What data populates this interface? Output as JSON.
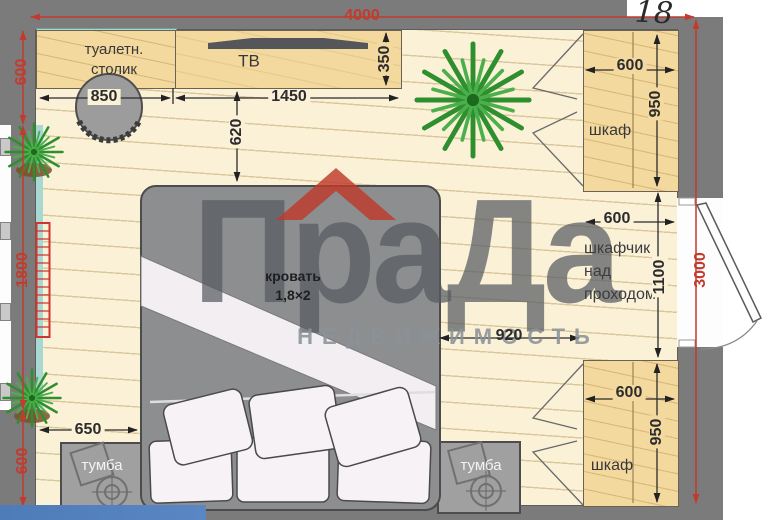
{
  "plan_type": "bedroom floor plan",
  "annotations": {
    "area_number": "18"
  },
  "watermark": {
    "brand": "ПраДа",
    "subtitle": "НЕДВИЖИМОСТЬ",
    "roof_color": "#c0392b"
  },
  "labels": {
    "vanity": "туалетн.\nстолик",
    "tv": "ТВ",
    "wardrobe_top": "шкаф",
    "wardrobe_bottom": "шкаф",
    "overhead_cabinet": "шкафчик\nнад\nпроходом",
    "bed": "кровать\n1,8×2",
    "nightstand_left": "тумба",
    "nightstand_right": "тумба"
  },
  "dimensions": {
    "room_width": "4000",
    "room_height": "3000",
    "left_wall_top": "600",
    "window": "1800",
    "left_wall_bottom": "600",
    "vanity_width": "850",
    "tv_console_width": "1450",
    "tv_console_depth": "350",
    "console_to_bed": "620",
    "wardrobe_top_width": "600",
    "wardrobe_top_depth": "950",
    "cabinet_width": "600",
    "cabinet_opening": "1100",
    "bed_to_wardrobe": "920",
    "wall_to_nightstand": "650",
    "wardrobe_bottom_width": "600",
    "wardrobe_bottom_depth": "950"
  },
  "colors": {
    "wall": "#7b7b7b",
    "floor": "#faf1d7",
    "furniture_tan": "#f4d99f",
    "dimension_red": "#c23b2e",
    "plant_green": "#2f8f2f",
    "banner_blue": "#4e7cb8"
  }
}
